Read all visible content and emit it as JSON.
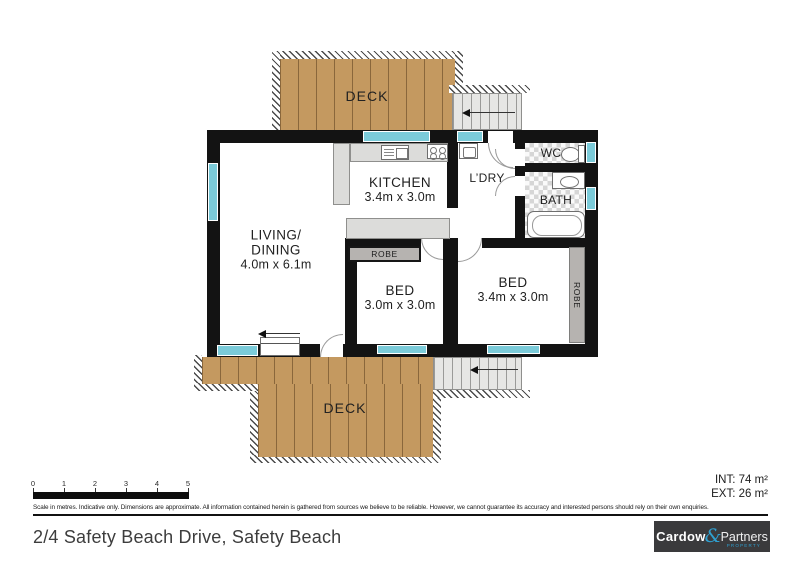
{
  "plan": {
    "deck_top": {
      "label": "DECK"
    },
    "deck_bottom": {
      "label": "DECK"
    },
    "living": {
      "line1": "LIVING/",
      "line2": "DINING",
      "dims": "4.0m x 6.1m"
    },
    "kitchen": {
      "label": "KITCHEN",
      "dims": "3.4m x 3.0m"
    },
    "laundry": {
      "label": "L’DRY"
    },
    "wc": {
      "label": "WC"
    },
    "bath": {
      "label": "BATH"
    },
    "bed1": {
      "label": "BED",
      "dims": "3.0m x 3.0m"
    },
    "bed2": {
      "label": "BED",
      "dims": "3.4m x 3.0m"
    },
    "robe1": {
      "label": "ROBE"
    },
    "robe2": {
      "label": "ROBE"
    }
  },
  "scale_bar": {
    "ticks": [
      "0",
      "1",
      "2",
      "3",
      "4",
      "5"
    ],
    "caption": "Scale in metres. Indicative only. Dimensions are approximate. All information contained herein is gathered from sources we believe to be reliable. However, we cannot guarantee its accuracy and interested persons should rely on their own enquiries."
  },
  "areas": {
    "interior": "INT: 74 m²",
    "exterior": "EXT: 26 m²"
  },
  "footer": {
    "address": "2/4 Safety Beach Drive, Safety Beach",
    "logo": {
      "name": "Cardow",
      "ampersand": "&",
      "partners": "Partners",
      "tagline": "PROPERTY"
    }
  },
  "colors": {
    "wall": "#131313",
    "window": "#7bcbd9",
    "deck_wood": "#c49960",
    "logo_blue": "#2f9fcf",
    "logo_bg": "#3a3a3c"
  }
}
